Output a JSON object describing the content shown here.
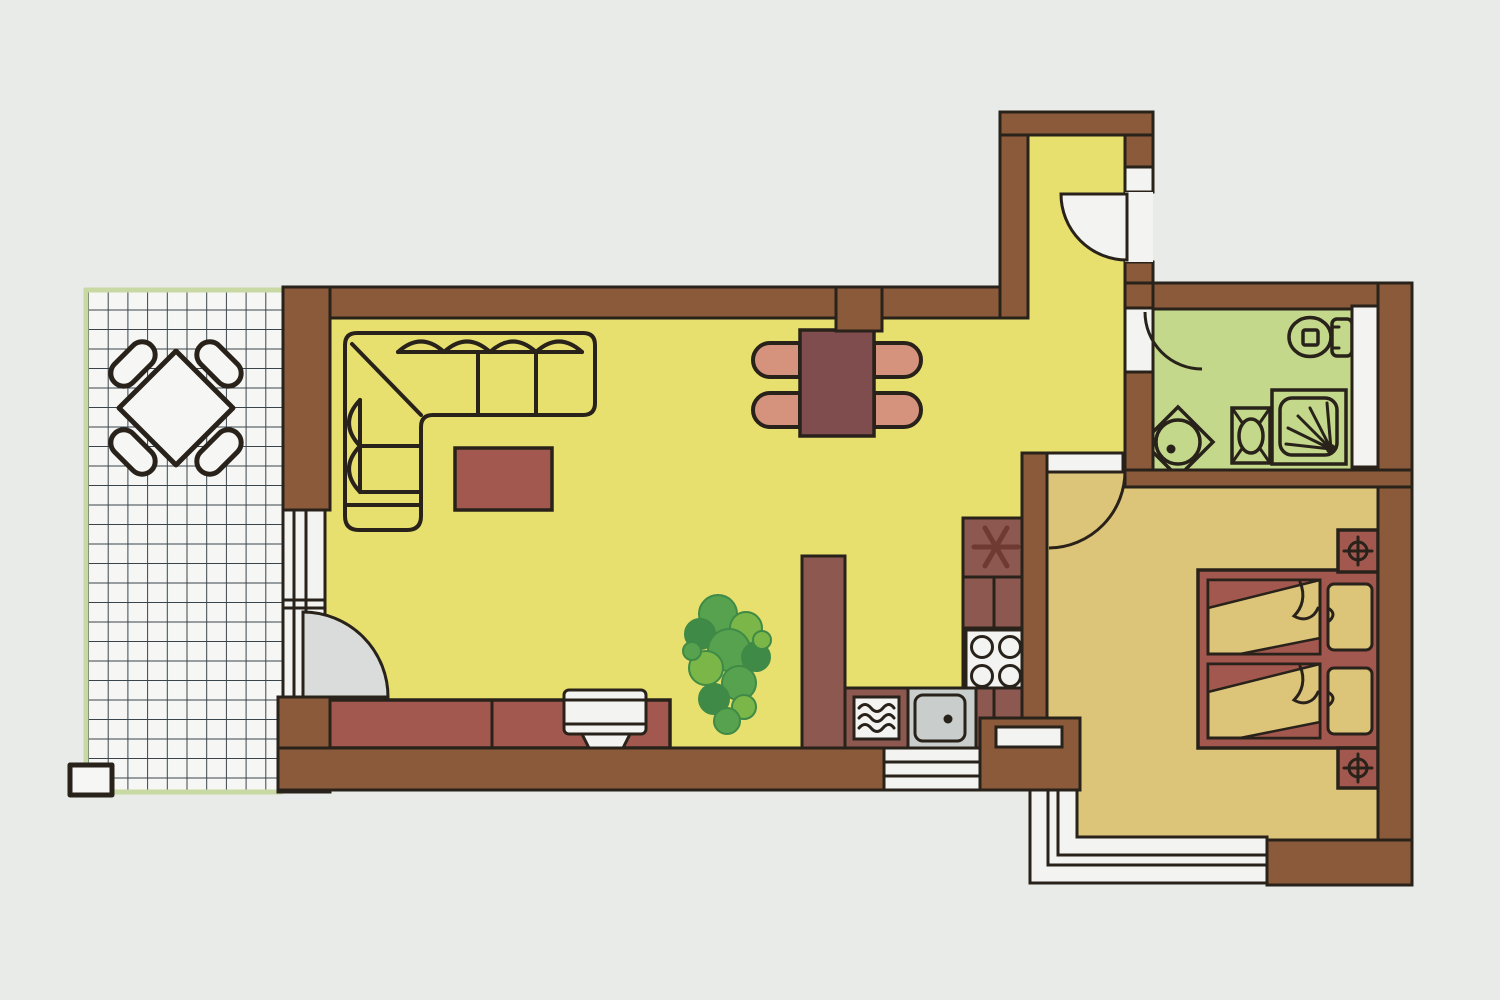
{
  "meta": {
    "title": "Apartment floor plan",
    "style": "hand-drawn colored architectural drawing, no text labels"
  },
  "palette": {
    "background": "#e9ebe8",
    "outline": "#28221a",
    "wall_brown": "#8a5a3b",
    "floor_living": "#e7e06f",
    "floor_bath": "#c3d88b",
    "floor_bedroom": "#dcc479",
    "terrace_tile_white": "#f6f7f5",
    "terrace_grid": "#39444b",
    "terrace_edge_green": "#c9d9a4",
    "maroon_furniture": "#a2584e",
    "dark_maroon_table": "#7f4d4d",
    "cabinet_maroon": "#8d5850",
    "salmon_chair": "#d5927c",
    "bed_tan": "#dcc479",
    "glass_gray": "#d9dcda",
    "white": "#f3f4f2",
    "counter_gray": "#c9cdcb",
    "plant_dark": "#3f8a46",
    "plant_mid": "#57a24e",
    "plant_light": "#7ab648",
    "symbol_dark": "#6e3a32"
  },
  "rooms": [
    {
      "name": "terrace",
      "floor": "white tile grid with green edge"
    },
    {
      "name": "living-dining-room",
      "floor": "yellow"
    },
    {
      "name": "kitchen",
      "floor": "yellow"
    },
    {
      "name": "entrance-hall",
      "floor": "yellow"
    },
    {
      "name": "bathroom",
      "floor": "green"
    },
    {
      "name": "bedroom",
      "floor": "tan"
    }
  ],
  "furniture_icons": [
    "terrace-table-icon",
    "terrace-chair-icon",
    "corner-sofa-icon",
    "coffee-table-icon",
    "sideboard-icon",
    "tv-icon",
    "plant-icon",
    "dining-table-icon",
    "dining-chair-icon",
    "kitchen-cabinet-icon",
    "pantry-star-icon",
    "stove-icon",
    "sink-icon",
    "washing-machine-icon",
    "toilet-icon",
    "corner-washbasin-icon",
    "bidet-icon",
    "shower-icon",
    "double-bed-icon",
    "nightstand-lamp-icon",
    "door-swing-icon",
    "window-icon"
  ]
}
